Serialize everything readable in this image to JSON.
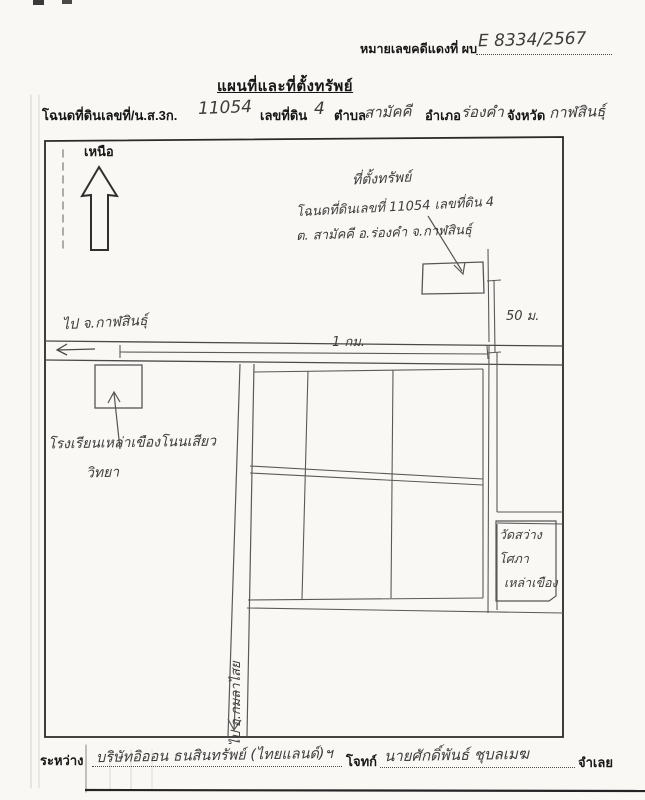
{
  "header": {
    "case_label": "หมายเลขคดีแดงที่ ผบ",
    "case_number": "E 8334/2567",
    "title": "แผนที่และที่ตั้งทรัพย์",
    "parcel": {
      "deed_label": "โฉนดที่ดินเลขที่/น.ส.3ก.",
      "deed_number": "11054",
      "parcel_no_label": "เลขที่ดิน",
      "parcel_no": "4",
      "subdistrict_label": "ตำบล",
      "subdistrict": "สามัคคี",
      "district_label": "อำเภอ",
      "district": "ร่องคำ",
      "province_label": "จังหวัด",
      "province": "กาฬสินธุ์"
    }
  },
  "map": {
    "north_label": "เหนือ",
    "property_note_line1": "ที่ตั้งทรัพย์",
    "property_note_line2": "โฉนดที่ดินเลขที่ 11054 เลขที่ดิน 4",
    "property_note_line3": "ต. สามัคคี อ.ร่องคำ จ.กาฬสินธุ์",
    "to_kalasin": "ไป จ.กาฬสินธุ์",
    "distance_1km": "1 กม.",
    "distance_50m": "50 ม.",
    "school_line1": "โรงเรียนเหล่าเขืองโนนเสียว",
    "school_line2": "วิทยา",
    "temple_line1": "วัดสว่าง",
    "temple_line2": "โศภา",
    "temple_line3": "เหล่าเขือง",
    "to_kamalasai": "ไป อ.กมลาไสย"
  },
  "footer": {
    "between_label": "ระหว่าง",
    "plaintiff": "บริษัทอิออน ธนสินทรัพย์ (ไทยแลนด์)ฯ",
    "plaintiff_label": "โจทก์",
    "defendant": "นายศักดิ์พันธ์ ชุบลเมฆ",
    "defendant_label": "จำเลย"
  },
  "colors": {
    "paper": "#f9f8f4",
    "ink": "#2a2a2a",
    "pencil": "#5a5a5a",
    "handwriting": "#3c3c3c"
  }
}
